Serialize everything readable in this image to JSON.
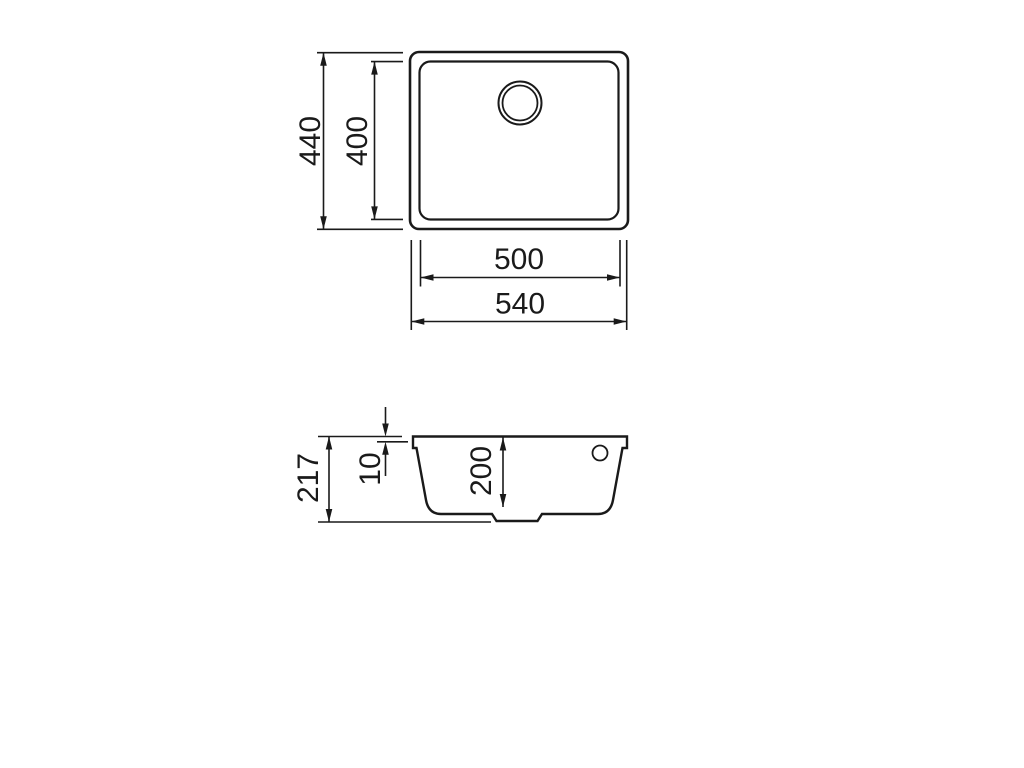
{
  "canvas": {
    "background": "#ffffff",
    "line_color": "#1a1a1a"
  },
  "views": {
    "top": {
      "dimensions": {
        "outer_height": "440",
        "inner_height": "400",
        "inner_width": "500",
        "outer_width": "540"
      }
    },
    "section": {
      "dimensions": {
        "overall_height": "217",
        "rim_height": "10",
        "bowl_depth": "200"
      }
    }
  }
}
